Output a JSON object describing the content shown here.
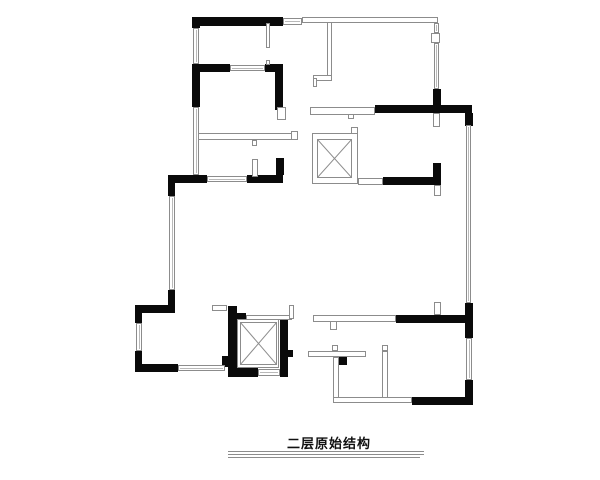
{
  "title": {
    "label": "二层原始结构",
    "rules": [
      [
        228,
        451,
        196
      ],
      [
        228,
        454,
        196
      ],
      [
        228,
        457,
        192
      ]
    ]
  },
  "colors": {
    "wall": "#0a0a0a",
    "line": "#8c8c8c",
    "fill": "#ffffff"
  },
  "plan": {
    "black_walls": [
      [
        193,
        17,
        90,
        9
      ],
      [
        192,
        17,
        8,
        11
      ],
      [
        192,
        64,
        8,
        43
      ],
      [
        200,
        64,
        30,
        8
      ],
      [
        265,
        64,
        18,
        8
      ],
      [
        275,
        64,
        8,
        46
      ],
      [
        375,
        105,
        97,
        8
      ],
      [
        433,
        89,
        8,
        16
      ],
      [
        465,
        113,
        8,
        13
      ],
      [
        168,
        175,
        39,
        8
      ],
      [
        247,
        175,
        36,
        8
      ],
      [
        276,
        158,
        8,
        17
      ],
      [
        168,
        183,
        7,
        13
      ],
      [
        168,
        290,
        7,
        15
      ],
      [
        135,
        305,
        40,
        8
      ],
      [
        135,
        313,
        7,
        10
      ],
      [
        135,
        351,
        7,
        13
      ],
      [
        135,
        364,
        43,
        8
      ],
      [
        228,
        306,
        9,
        71
      ],
      [
        237,
        313,
        9,
        7
      ],
      [
        280,
        318,
        8,
        59
      ],
      [
        288,
        350,
        5,
        7
      ],
      [
        228,
        368,
        30,
        9
      ],
      [
        280,
        368,
        8,
        9
      ],
      [
        222,
        356,
        11,
        11
      ],
      [
        383,
        177,
        58,
        8
      ],
      [
        433,
        163,
        8,
        14
      ],
      [
        396,
        315,
        70,
        8
      ],
      [
        465,
        303,
        8,
        35
      ],
      [
        465,
        380,
        8,
        25
      ],
      [
        412,
        397,
        60,
        8
      ],
      [
        338,
        356,
        9,
        9
      ]
    ],
    "windows": [
      [
        283,
        18,
        19,
        7
      ],
      [
        230,
        65,
        35,
        6
      ],
      [
        207,
        176,
        40,
        6
      ],
      [
        193,
        28,
        6,
        36
      ],
      [
        193,
        107,
        6,
        68
      ],
      [
        169,
        196,
        6,
        94
      ],
      [
        136,
        323,
        6,
        28
      ],
      [
        178,
        365,
        47,
        6
      ],
      [
        258,
        369,
        22,
        7
      ],
      [
        466,
        125,
        5,
        178
      ],
      [
        466,
        338,
        6,
        42
      ],
      [
        434,
        43,
        5,
        46
      ],
      [
        434,
        23,
        5,
        10
      ]
    ],
    "light_walls": [
      [
        302,
        17,
        136,
        6
      ],
      [
        310,
        107,
        65,
        8
      ],
      [
        358,
        178,
        25,
        7
      ],
      [
        333,
        397,
        79,
        6
      ],
      [
        313,
        315,
        83,
        7
      ],
      [
        246,
        315,
        46,
        5
      ],
      [
        212,
        305,
        15,
        6
      ],
      [
        252,
        159,
        6,
        18
      ],
      [
        266,
        23,
        4,
        25
      ],
      [
        266,
        60,
        4,
        5
      ],
      [
        327,
        22,
        5,
        56
      ],
      [
        313,
        75,
        19,
        6
      ],
      [
        313,
        78,
        4,
        9
      ],
      [
        198,
        133,
        98,
        7
      ],
      [
        291,
        131,
        7,
        9
      ],
      [
        252,
        140,
        5,
        6
      ],
      [
        348,
        114,
        6,
        5
      ],
      [
        330,
        321,
        7,
        9
      ],
      [
        332,
        345,
        6,
        6
      ],
      [
        308,
        351,
        58,
        6
      ],
      [
        333,
        357,
        6,
        41
      ],
      [
        382,
        351,
        6,
        47
      ],
      [
        382,
        345,
        6,
        6
      ],
      [
        289,
        305,
        5,
        14
      ],
      [
        351,
        127,
        7,
        7
      ]
    ],
    "jambs": [
      [
        277,
        107,
        9,
        13
      ],
      [
        431,
        33,
        9,
        10
      ],
      [
        433,
        113,
        7,
        14
      ],
      [
        434,
        185,
        7,
        11
      ],
      [
        434,
        302,
        7,
        13
      ]
    ],
    "shafts": [
      {
        "outer": [
          312,
          133,
          46,
          51
        ],
        "inner": [
          317,
          139,
          35,
          39
        ]
      },
      {
        "outer": [
          237,
          319,
          42,
          49
        ],
        "inner": [
          240,
          322,
          37,
          43
        ]
      }
    ]
  }
}
